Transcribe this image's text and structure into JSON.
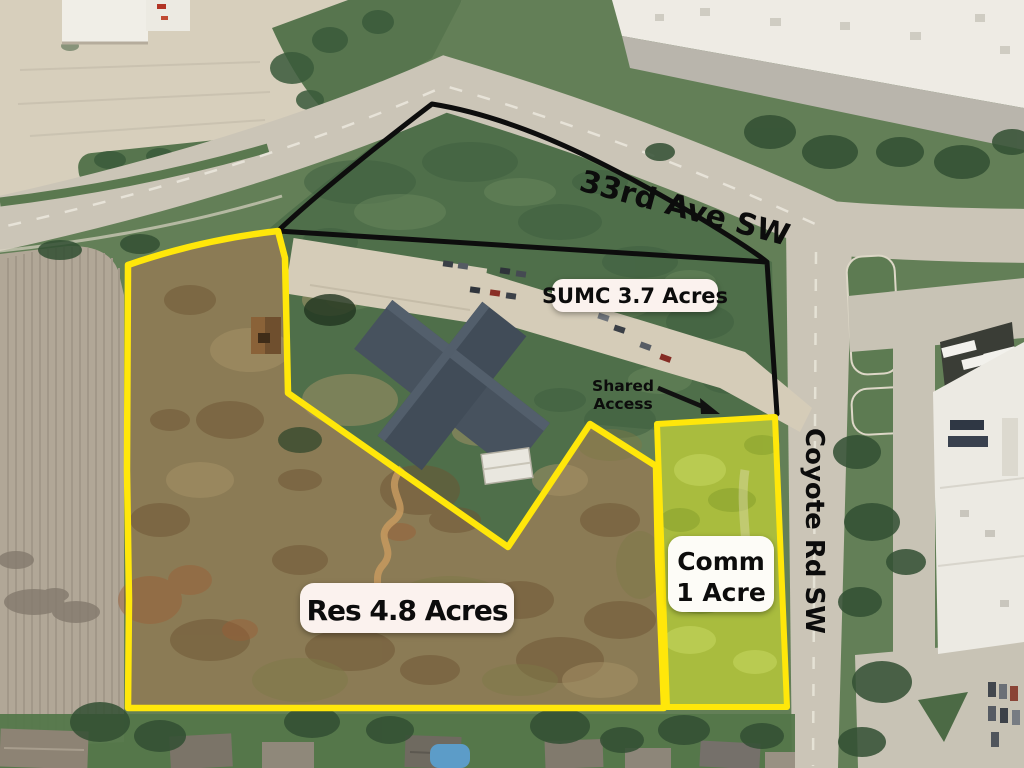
{
  "map": {
    "labels": {
      "avenue": "33rd Ave SW",
      "coyote": "Coyote Rd SW"
    },
    "parcels": {
      "sumc": {
        "label": "SUMC 3.7 Acres"
      },
      "res": {
        "label": "Res 4.8 Acres"
      },
      "comm": {
        "line1": "Comm",
        "line2": "1 Acre"
      }
    },
    "annotations": {
      "shared_access": {
        "line1": "Shared",
        "line2": "Access"
      }
    },
    "colors": {
      "boundary_yellow": "#ffe70a",
      "boundary_black": "#0d0d0d",
      "pill_bg": "#fbf2ee",
      "pill_bg_white": "#fdfcf7",
      "comm_fill": "#a9bc3e",
      "res_fill": "#8b7b55"
    }
  }
}
